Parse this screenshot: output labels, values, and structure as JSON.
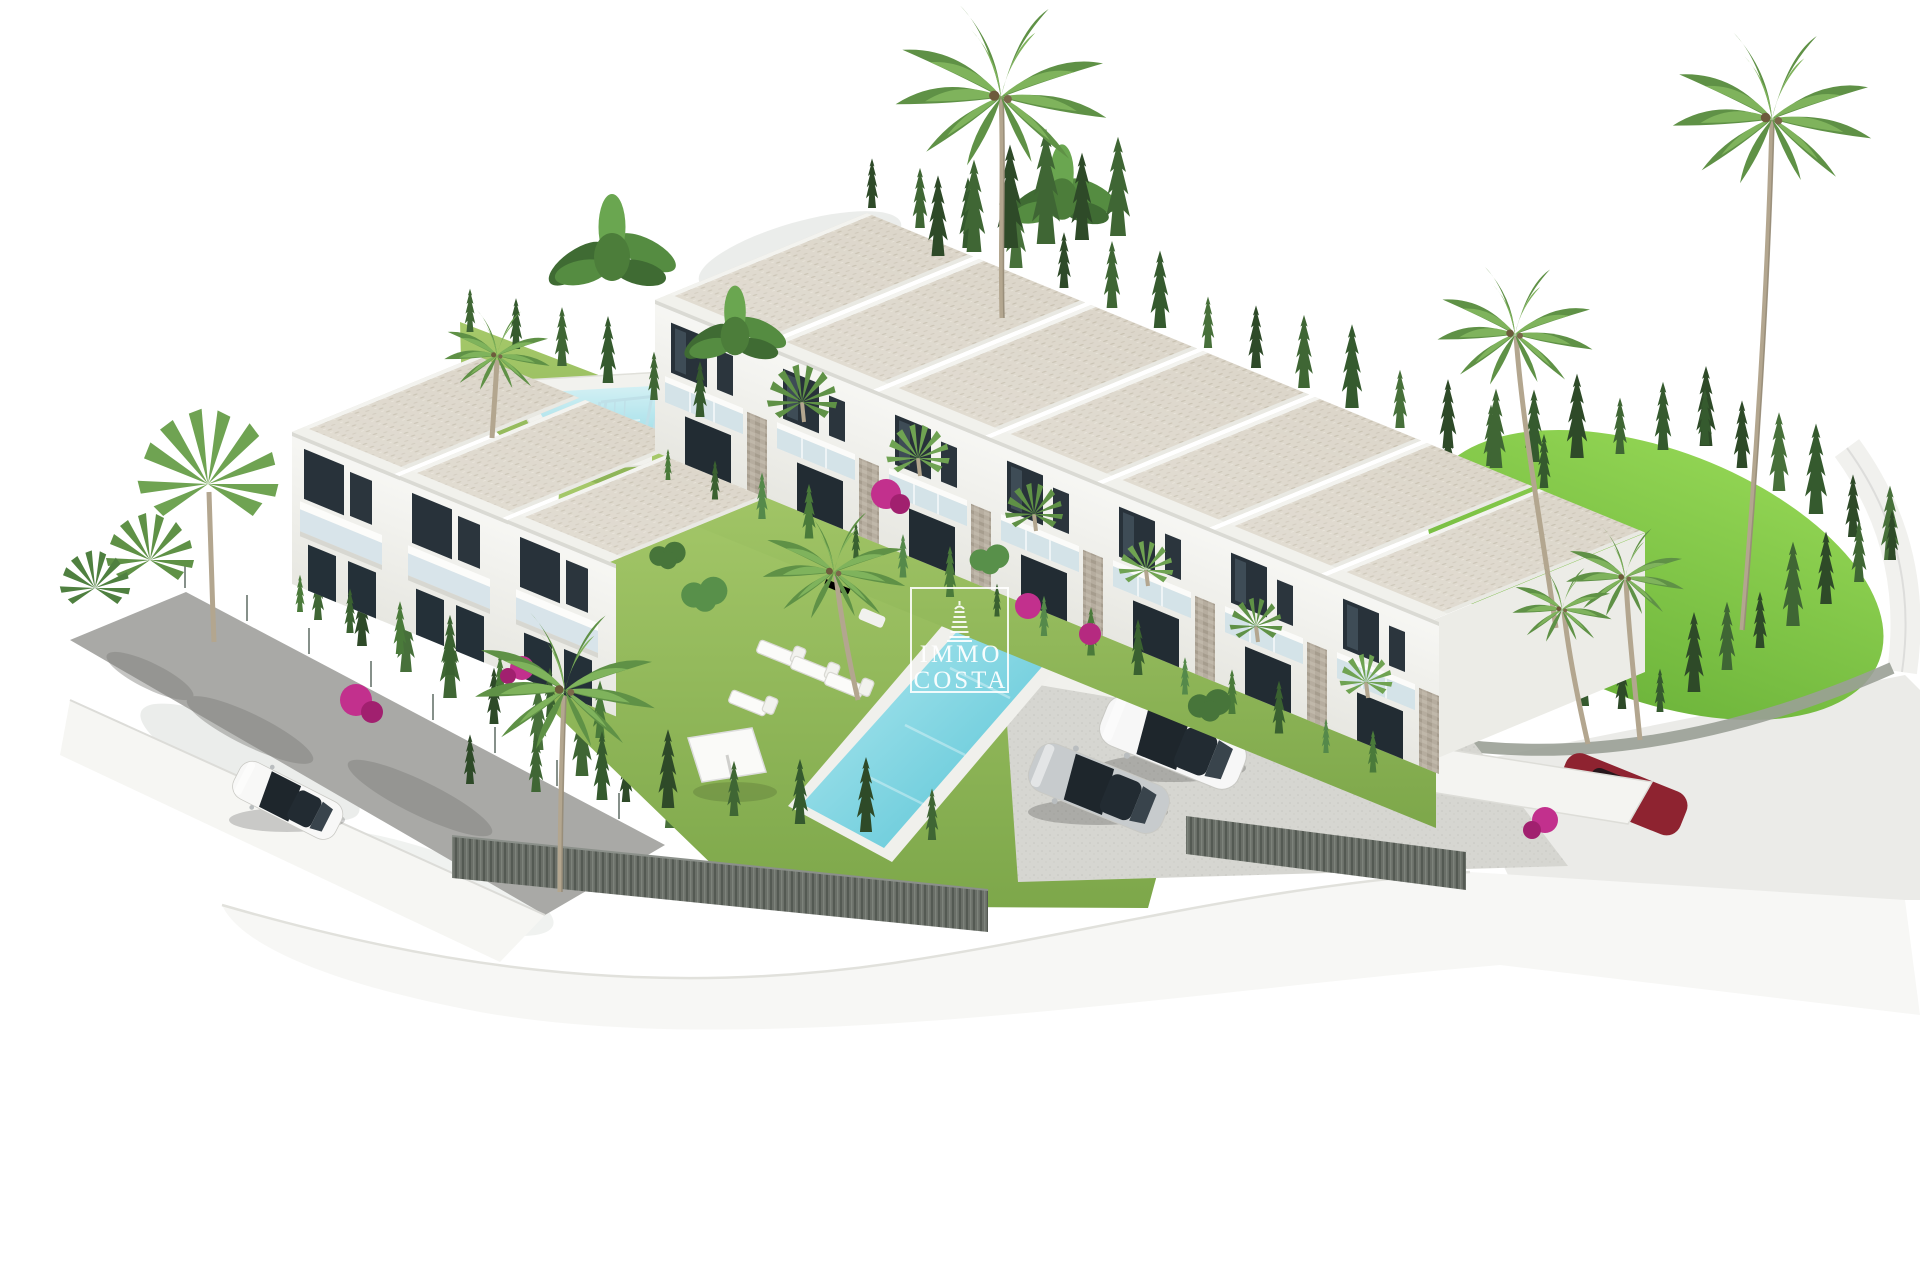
{
  "watermark": {
    "line1": "IMMO",
    "line2": "COSTA",
    "icon": "lighthouse-icon"
  },
  "scene": {
    "type": "3d-architectural-aerial-render",
    "subject": "white Mediterranean townhouse development with gardens, two pools and parking",
    "townhouse_units_right_row": 7,
    "left_building_bays": 3,
    "pools": 2,
    "vehicles": [
      "white sedan",
      "silver sedan",
      "dark red car",
      "white street car"
    ],
    "palette": {
      "background": "#ffffff",
      "roof_gravel": "#dcd6ca",
      "wall_white": "#f4f4f1",
      "window_dark": "#28323a",
      "balcony_glass": "#cfe0e8",
      "grass": "#8fb554",
      "lawn_bright": "#7cc143",
      "hedge_dark": "#33512c",
      "palm_green": "#5f9146",
      "pool_water": "#55c4d6",
      "road_gray": "#a9a9a6",
      "concrete": "#d6d6d1",
      "slat_fence": "#6a6f68",
      "stone_clad": "#b6ad9f",
      "bougainvillea": "#c2308d",
      "car_red": "#8e2330"
    }
  }
}
